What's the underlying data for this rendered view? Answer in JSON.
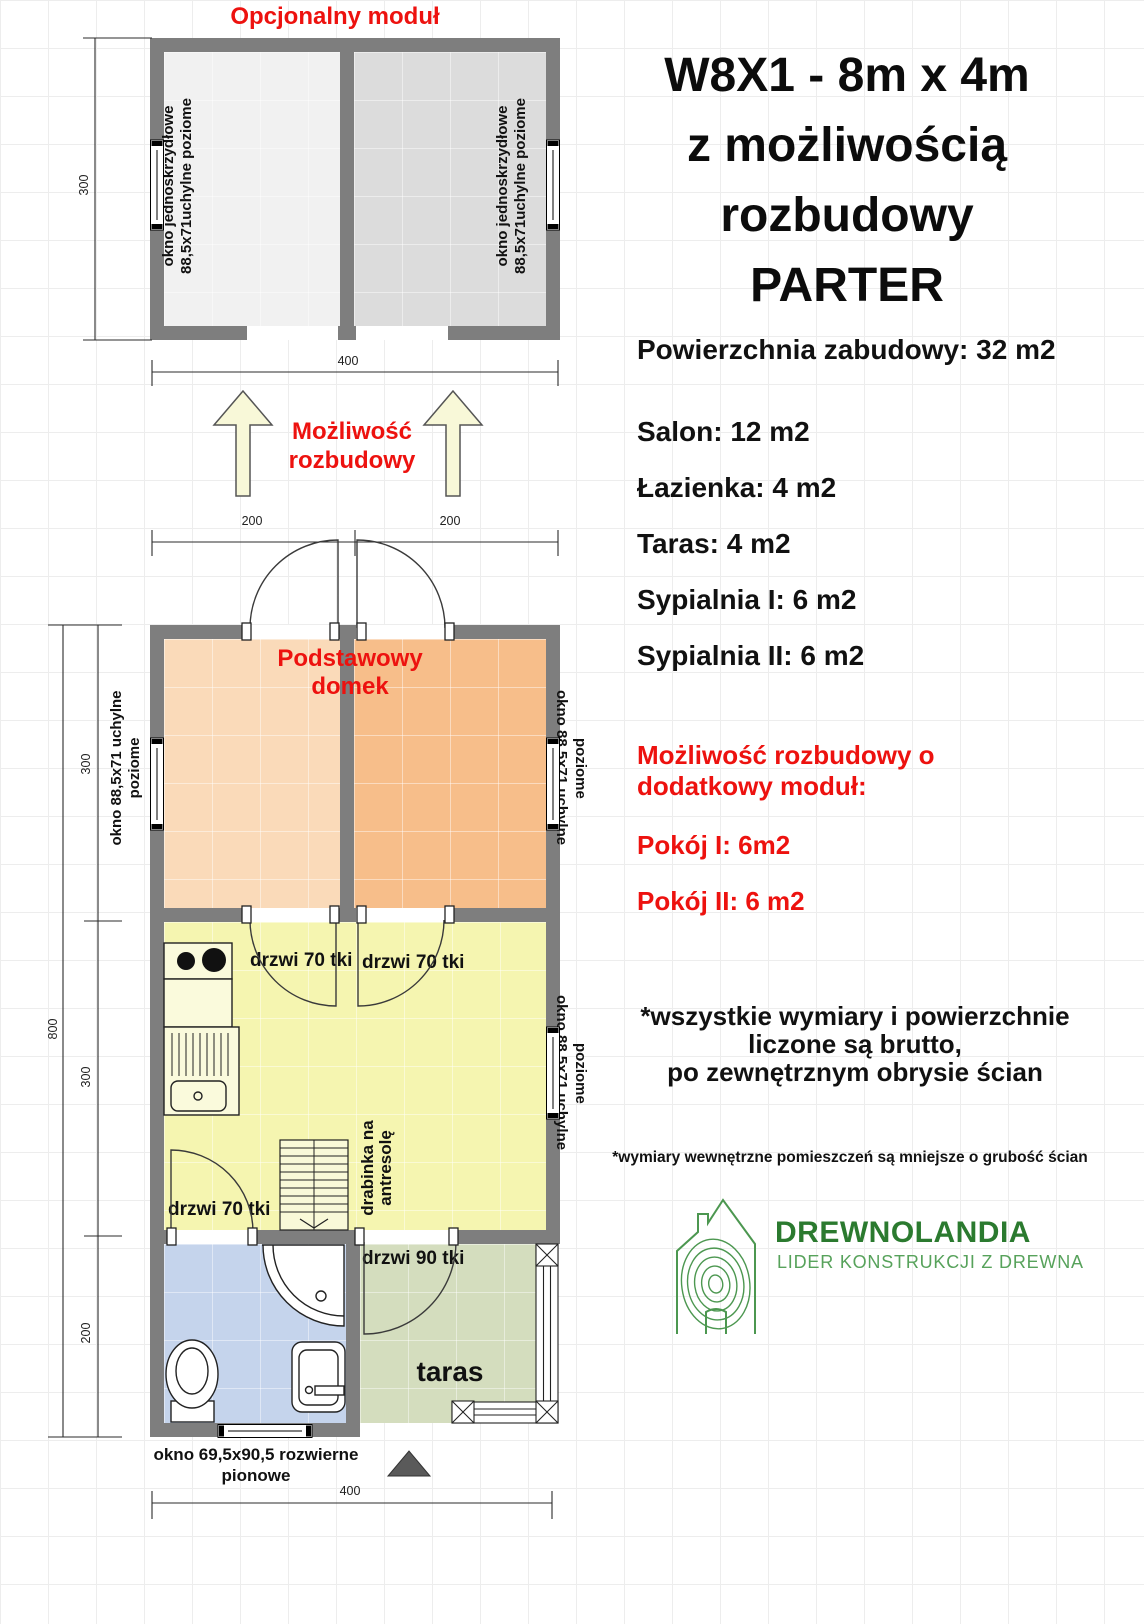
{
  "optional_module": {
    "title": "Opcjonalny moduł",
    "window_label_line1": "okno jednoskrzydłowe",
    "window_label_line2": "88,5x71uchylne poziome",
    "dim_height": "300",
    "dim_width": "400"
  },
  "expansion": {
    "label_line1": "Możliwość",
    "label_line2": "rozbudowy",
    "dim_left": "200",
    "dim_right": "200"
  },
  "main_house": {
    "title_line1": "Podstawowy",
    "title_line2": "domek",
    "window_label_line1": "okno 88,5x71 uchylne",
    "window_label_line2": "poziome",
    "door_70_label": "drzwi 70 tki",
    "door_90_label": "drzwi 90 tki",
    "ladder_label_line1": "drabinka na",
    "ladder_label_line2": "antresolę",
    "terrace_label": "taras",
    "bottom_window_line1": "okno 69,5x90,5 rozwierne",
    "bottom_window_line2": "pionowe",
    "dims": {
      "total_height": "800",
      "bedrooms_height": "300",
      "salon_height": "300",
      "bath_height": "200",
      "width": "400"
    }
  },
  "info_panel": {
    "title_line1": "W8X1 - 8m x 4m",
    "title_line2": "z możliwością",
    "title_line3": "rozbudowy",
    "title_line4": "PARTER",
    "total_area": "Powierzchnia zabudowy: 32 m2",
    "rooms": [
      "Salon: 12 m2",
      "Łazienka: 4 m2",
      "Taras: 4 m2",
      "Sypialnia I: 6 m2",
      "Sypialnia II: 6 m2"
    ],
    "expansion_note_line1": "Możliwość rozbudowy o",
    "expansion_note_line2": "dodatkowy moduł:",
    "expansion_room_1": "Pokój I: 6m2",
    "expansion_room_2": "Pokój II: 6 m2",
    "disclaimer_line1": "*wszystkie wymiary i powierzchnie",
    "disclaimer_line2": "liczone są brutto,",
    "disclaimer_line3": "po zewnętrznym obrysie ścian",
    "note": "*wymiary wewnętrzne pomieszczeń są mniejsze o grubość ścian",
    "logo": {
      "name": "DREWNOLANDIA",
      "tagline": "LIDER KONSTRUKCJI Z DREWNA"
    }
  },
  "colors": {
    "wall": "#7e7e7e",
    "accent_red": "#ed120f",
    "module_room_left": "#f1f1f1",
    "module_room_right": "#dcdcdc",
    "bedroom_left": "#fadab9",
    "bedroom_right": "#f7be8a",
    "salon": "#f5f5b0",
    "bathroom": "#c5d4ec",
    "terrace": "#d4ddbe",
    "logo_green": "#2b7a2f"
  }
}
